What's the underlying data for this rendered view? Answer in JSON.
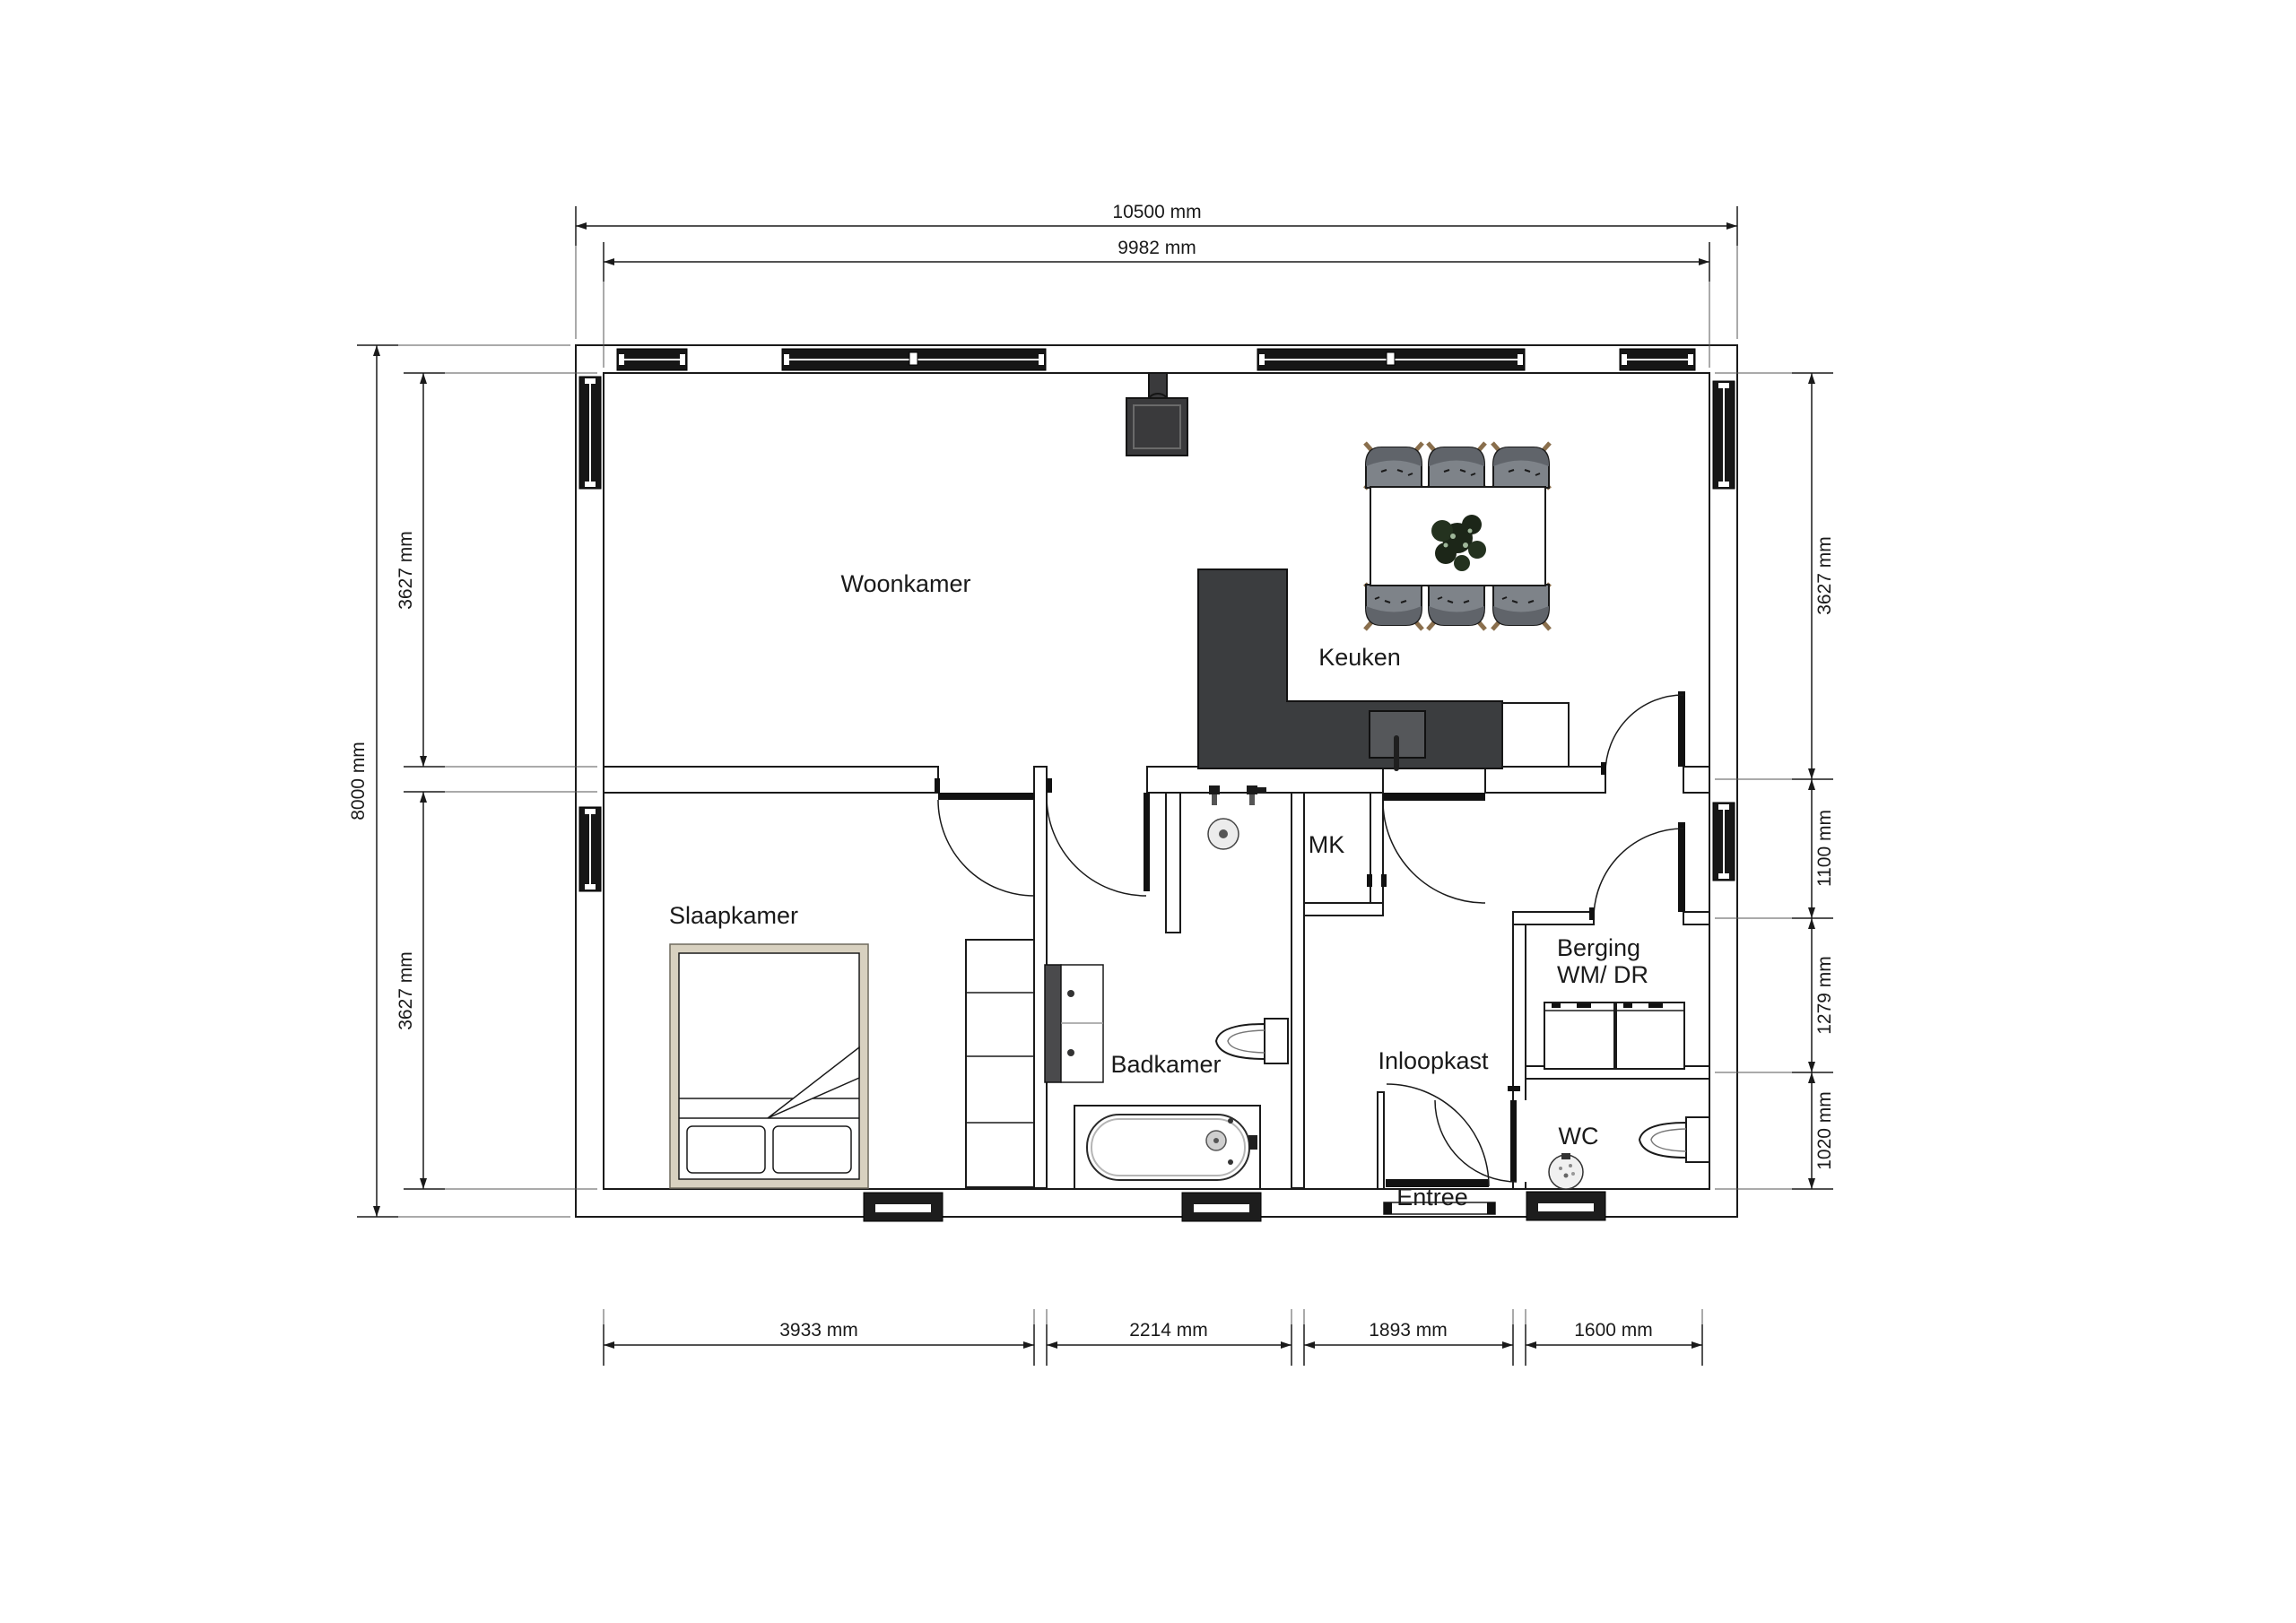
{
  "drawing": {
    "type": "floor-plan",
    "units": "mm"
  },
  "rooms": {
    "woonkamer": {
      "label": "Woonkamer"
    },
    "keuken": {
      "label": "Keuken"
    },
    "slaapkamer": {
      "label": "Slaapkamer"
    },
    "badkamer": {
      "label": "Badkamer"
    },
    "mk": {
      "label": "MK"
    },
    "inloopkast": {
      "label": "Inloopkast"
    },
    "berging_line1": {
      "label": "Berging"
    },
    "berging_line2": {
      "label": "WM/ DR"
    },
    "wc": {
      "label": "WC"
    },
    "entree": {
      "label": "Entree"
    }
  },
  "dims": {
    "top_outer": "10500 mm",
    "top_inner": "9982 mm",
    "left_total": "8000 mm",
    "left_upper": "3627 mm",
    "left_lower": "3627 mm",
    "right_upper": "3627 mm",
    "right_hall": "1100 mm",
    "right_berging": "1279 mm",
    "right_wc": "1020 mm",
    "bottom_slaapkamer": "3933 mm",
    "bottom_badkamer": "2214 mm",
    "bottom_inloopkast": "1893 mm",
    "bottom_berging": "1600 mm"
  },
  "colors": {
    "line": "#1a1a1a",
    "glazing": "#161616",
    "counter": "#3b3d3f",
    "sink": "#55575a",
    "chair": "#7e8389",
    "chair_shade": "#60646a",
    "bed_frame": "#d8d1c0",
    "plant": "#1c2618",
    "vent": "#1d1d1d",
    "stove": "#3a3a3c"
  }
}
